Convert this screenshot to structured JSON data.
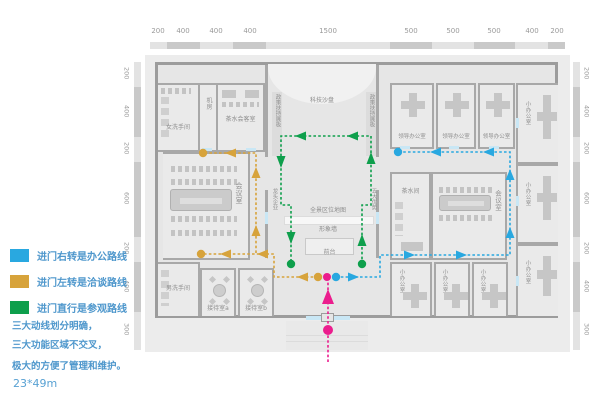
{
  "colors": {
    "office_route_blue": "#29a8e0",
    "negotiation_route_yellow": "#d7a33b",
    "tour_route_green": "#0e9f4c",
    "entrance_pink": "#eb1d8d",
    "legend_text_blue": "#4e97cc"
  },
  "legend": {
    "items": [
      {
        "label": "进门右转是办公路线",
        "color": "#29a8e0"
      },
      {
        "label": "进门左转是洽谈路线",
        "color": "#d7a33b"
      },
      {
        "label": "进门直行是参观路线",
        "color": "#0e9f4c"
      }
    ],
    "notes": [
      "三大动线划分明确，",
      "三大功能区域不交叉，",
      "极大的方便了管理和维护。"
    ],
    "size_note": "23*49m"
  },
  "rulers": {
    "top": [
      "200",
      "400",
      "400",
      "400",
      "1500",
      "500",
      "500",
      "500",
      "400",
      "200"
    ],
    "left": [
      "200",
      "400",
      "200",
      "600",
      "200",
      "400",
      "300"
    ],
    "right": [
      "200",
      "400",
      "200",
      "600",
      "200",
      "400",
      "300"
    ]
  },
  "plan": {
    "labels": {
      "women_restroom": "女洗手间",
      "men_restroom": "男洗手间",
      "machine_room": "机房",
      "tea_reception_room": "茶水会客室",
      "tech_sandtable": "科技沙盘",
      "policy_board": "政策扶持展板",
      "leader_office": "领导办公室",
      "small_office": "小办公室",
      "tea_room": "茶水间",
      "meeting_room": "会议室",
      "panorama_map": "全景区位地图",
      "image_wall": "形象墙",
      "front_desk": "前台",
      "leading_enterprise": "龙头企业",
      "five_advantages": "五大优势",
      "reception_a": "接待室a",
      "reception_b": "接待室b"
    }
  }
}
